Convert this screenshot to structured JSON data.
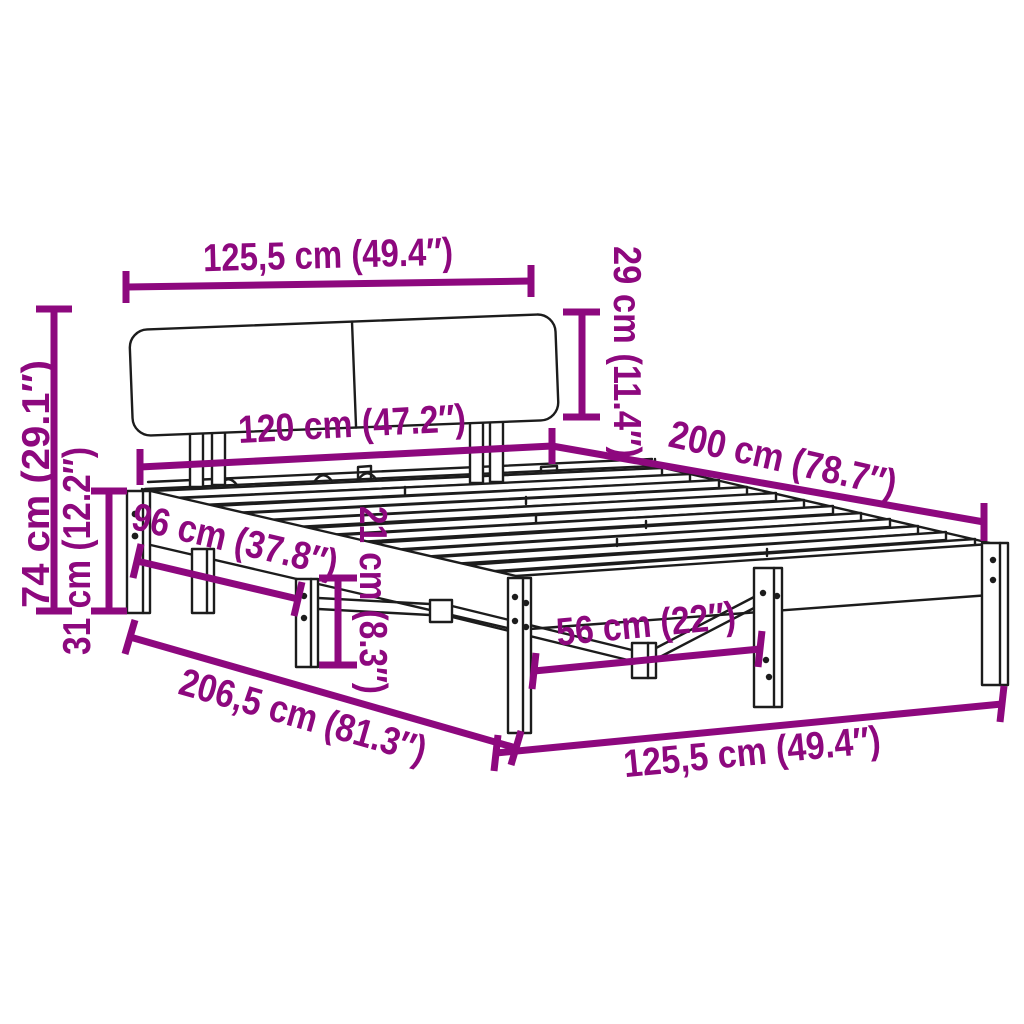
{
  "figure": {
    "type": "product-dimension-diagram",
    "subject": "bed frame with headboard and slatted base"
  },
  "style": {
    "dimension_color": "#8d087e",
    "drawing_color": "#1c1c1c",
    "background_color": "#ffffff"
  },
  "dimensions": {
    "headboard_width": {
      "label": "125,5 cm (49.4″)",
      "cm": "125,5",
      "inches": "49.4"
    },
    "headboard_height": {
      "label": "29 cm (11.4″)",
      "cm": "29",
      "inches": "11.4"
    },
    "mattress_width": {
      "label": "120 cm (47.2″)",
      "cm": "120",
      "inches": "47.2"
    },
    "bed_length": {
      "label": "200 cm (78.7″)",
      "cm": "200",
      "inches": "78.7"
    },
    "total_height": {
      "label": "74 cm (29.1″)",
      "cm": "74",
      "inches": "29.1"
    },
    "side_rail_height": {
      "label": "31 cm (12.2″)",
      "cm": "31",
      "inches": "12.2"
    },
    "head_leg_span": {
      "label": "96 cm (37.8″)",
      "cm": "96",
      "inches": "37.8"
    },
    "under_bed_clearance": {
      "label": "21 cm (8.3″)",
      "cm": "21",
      "inches": "8.3"
    },
    "foot_leg_span": {
      "label": "56 cm (22″)",
      "cm": "56",
      "inches": "22"
    },
    "total_length": {
      "label": "206,5 cm (81.3″)",
      "cm": "206,5",
      "inches": "81.3"
    },
    "frame_width": {
      "label": "125,5 cm (49.4″)",
      "cm": "125,5",
      "inches": "49.4"
    }
  }
}
